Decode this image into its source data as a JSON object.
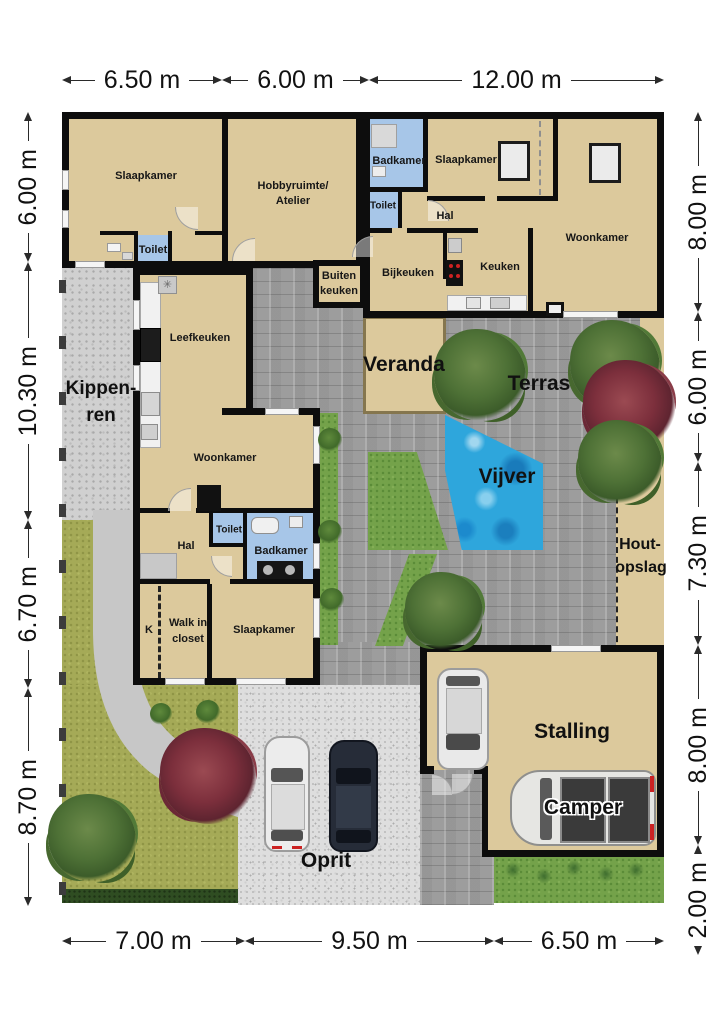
{
  "dimensions": {
    "top": [
      "6.50 m",
      "6.00 m",
      "12.00 m"
    ],
    "bottom": [
      "7.00 m",
      "9.50 m",
      "6.50 m"
    ],
    "left": [
      "6.00 m",
      "10.30 m",
      "6.70 m",
      "8.70 m"
    ],
    "right": [
      "8.00 m",
      "6.00 m",
      "7.30 m",
      "8.00 m",
      "2.00 m"
    ]
  },
  "houses": {
    "house1": {
      "slaapkamer": "Slaapkamer",
      "hobby_line1": "Hobbyruimte/",
      "hobby_line2": "Atelier",
      "toilet": "Toilet"
    },
    "house2": {
      "badkamer": "Badkamer",
      "slaapkamer": "Slaapkamer",
      "toilet": "Toilet",
      "hal": "Hal",
      "woonkamer": "Woonkamer",
      "keuken": "Keuken",
      "bijkeuken": "Bijkeuken",
      "buiten_line1": "Buiten",
      "buiten_line2": "keuken"
    },
    "house3": {
      "leefkeuken": "Leefkeuken",
      "woonkamer": "Woonkamer",
      "hal": "Hal",
      "toilet": "Toilet",
      "badkamer": "Badkamer",
      "walkin_line1": "Walk in",
      "walkin_line2": "closet",
      "kast": "K",
      "slaapkamer": "Slaapkamer"
    }
  },
  "outdoor": {
    "kippen_line1": "Kippen-",
    "kippen_line2": "ren",
    "veranda": "Veranda",
    "terras": "Terras",
    "vijver": "Vijver",
    "hout_line1": "Hout-",
    "hout_line2": "opslag",
    "stalling": "Stalling",
    "camper": "Camper",
    "oprit": "Oprit"
  },
  "colors": {
    "wall": "#0d0d0d",
    "room_beige": "#dcc99c",
    "wet_room_blue": "#a7c6e8",
    "terras_gray": "#9d9d9d",
    "path_gray": "#c7c7c7",
    "gravel_light": "#d0d0d0",
    "oprit_gray": "#dedede",
    "lawn_olive": "#a5aa57",
    "grass_green": "#74a24a",
    "hedge_green": "#2f4d22",
    "pond_blue": "#2ea6dc",
    "tree_green": "#4e7136",
    "tree_red": "#7c2f3c",
    "stove_red": "#cc2222"
  }
}
